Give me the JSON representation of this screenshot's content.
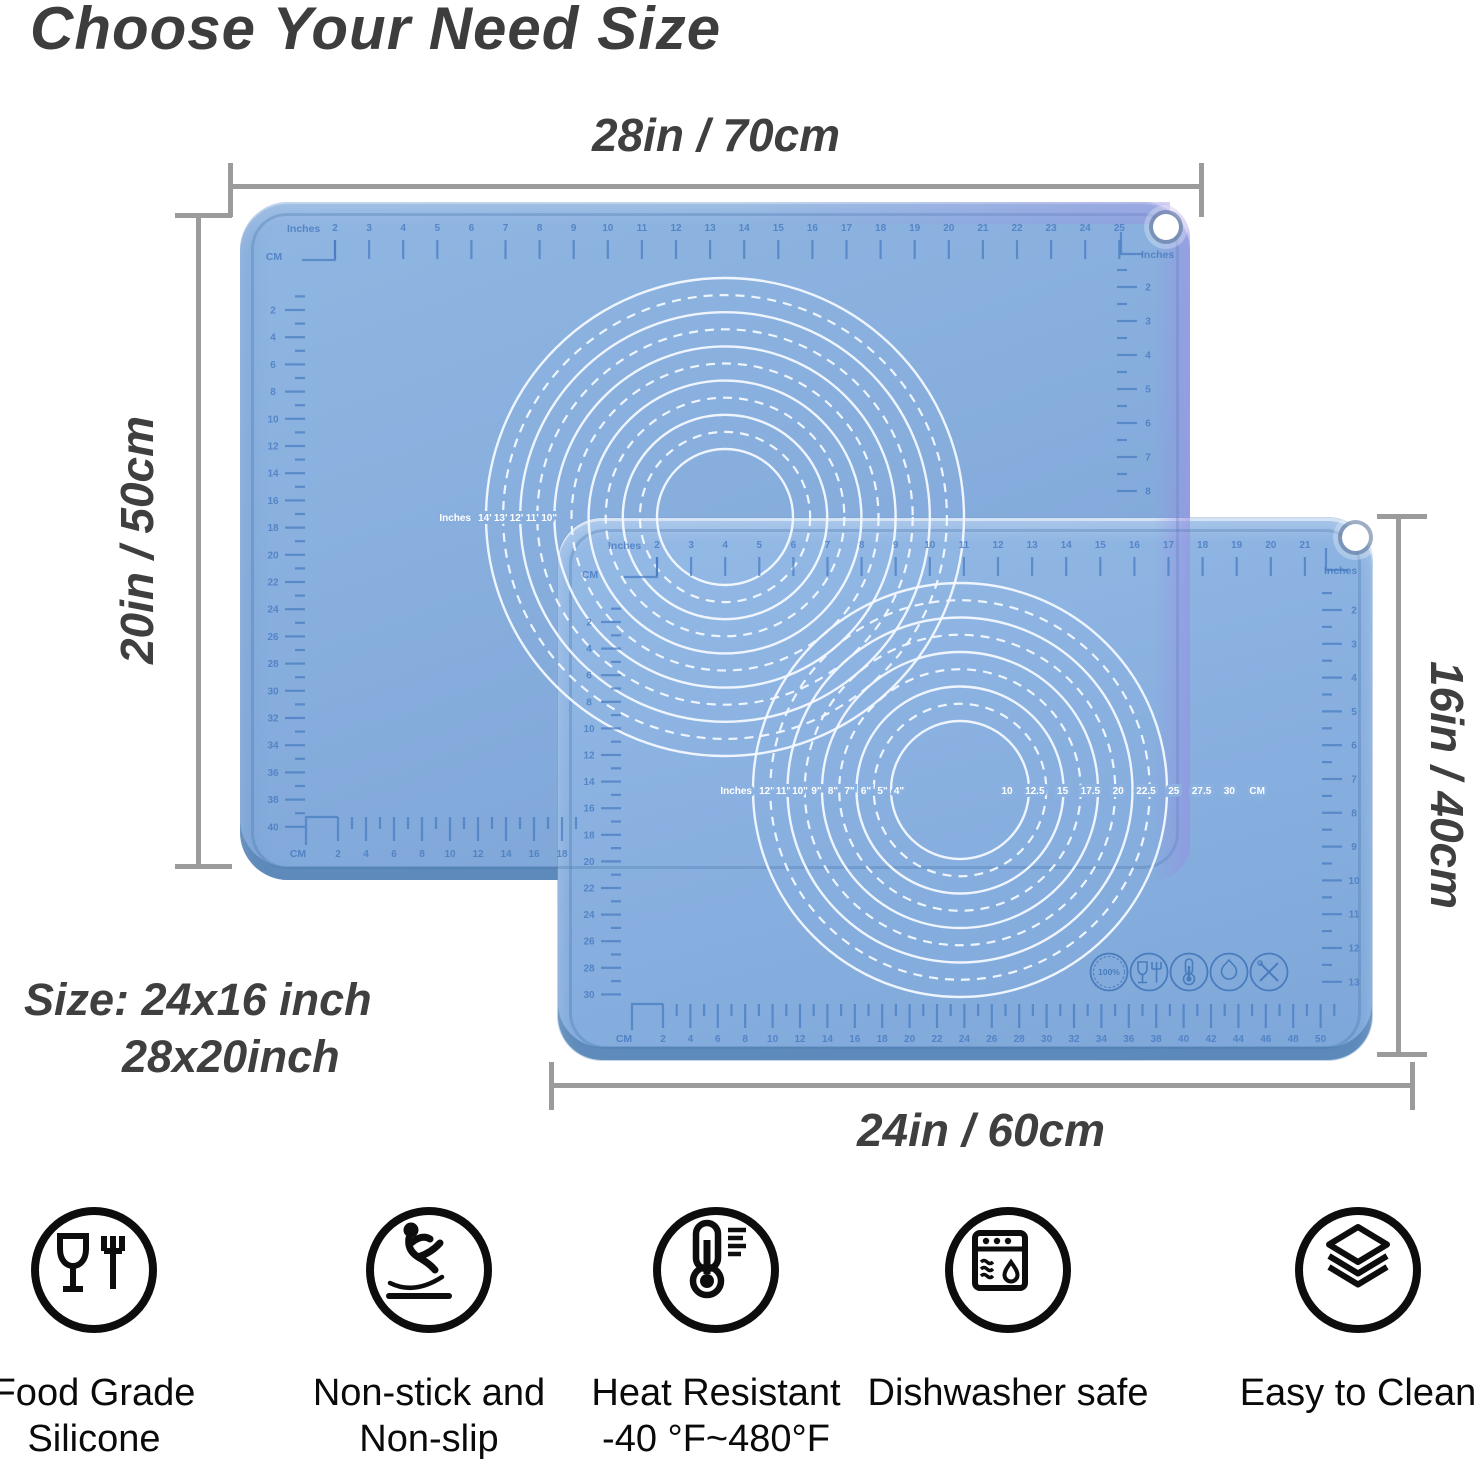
{
  "title": "Choose Your Need Size",
  "dimensions": {
    "top": "28in / 70cm",
    "left": "20in / 50cm",
    "right": "16in / 40cm",
    "bottom": "24in / 60cm"
  },
  "size_note": {
    "line1": "Size: 24x16 inch",
    "line2": "28x20inch"
  },
  "colors": {
    "mat_big": "#87aedd",
    "mat_front": "#8ab1e0",
    "ruler_ink": "#4579c0",
    "circle_white": "#f4f9ff",
    "dim_gray": "#9b9b9b",
    "text_dark": "#3f3f3f",
    "purple_edge": "#988ce2"
  },
  "mats": {
    "big": {
      "rulers": {
        "top": {
          "label": "Inches",
          "numbers": [
            2,
            3,
            4,
            5,
            6,
            7,
            8,
            9,
            10,
            11,
            12,
            13,
            14,
            15,
            16,
            17,
            18,
            19,
            20,
            21,
            22,
            23,
            24,
            25
          ]
        },
        "left": {
          "label": "CM",
          "numbers": [
            2,
            4,
            6,
            8,
            10,
            12,
            14,
            16,
            18,
            20,
            22,
            24,
            26,
            28,
            30,
            32,
            34,
            36,
            38,
            40
          ]
        },
        "right": {
          "label": "Inches",
          "numbers": [
            2,
            3,
            4,
            5,
            6,
            7,
            8
          ]
        },
        "bottom": {
          "label": "CM",
          "numbers": [
            2,
            4,
            6,
            8,
            10,
            12,
            14,
            16,
            18
          ]
        }
      },
      "circle_labels_left": [
        "Inches",
        "14\"",
        "13\"",
        "12\"",
        "11\"",
        "10\""
      ]
    },
    "front": {
      "rulers": {
        "top": {
          "label": "Inches",
          "numbers": [
            2,
            3,
            4,
            5,
            6,
            7,
            8,
            9,
            10,
            11,
            12,
            13,
            14,
            15,
            16,
            17,
            18,
            19,
            20,
            21
          ]
        },
        "left": {
          "label": "CM",
          "numbers": [
            2,
            4,
            6,
            8,
            10,
            12,
            14,
            16,
            18,
            20,
            22,
            24,
            26,
            28,
            30
          ]
        },
        "right": {
          "label": "Inches",
          "numbers": [
            2,
            3,
            4,
            5,
            6,
            7,
            8,
            9,
            10,
            11,
            12,
            13
          ]
        },
        "bottom": {
          "label": "CM",
          "numbers": [
            2,
            4,
            6,
            8,
            10,
            12,
            14,
            16,
            18,
            20,
            22,
            24,
            26,
            28,
            30,
            32,
            34,
            36,
            38,
            40,
            42,
            44,
            46,
            48,
            50
          ]
        }
      },
      "circle_labels_left": [
        "Inches",
        "12\"",
        "11\"",
        "10\"",
        "9\"",
        "8\"",
        "7\"",
        "6\"",
        "5\"",
        "4\""
      ],
      "circle_labels_right": [
        "10",
        "12.5",
        "15",
        "17.5",
        "20",
        "22.5",
        "25",
        "27.5",
        "30",
        "CM"
      ],
      "badges": [
        {
          "icon": "badge-100-food-grade-icon",
          "text": "100%"
        },
        {
          "icon": "badge-glass-fork-icon"
        },
        {
          "icon": "badge-thermometer-icon"
        },
        {
          "icon": "badge-flame-icon"
        },
        {
          "icon": "badge-crossed-utensils-icon"
        }
      ]
    }
  },
  "features": [
    {
      "icon": "food-safe-icon",
      "lines": [
        "Food Grade",
        "Silicone"
      ]
    },
    {
      "icon": "non-slip-icon",
      "lines": [
        "Non-stick and",
        "Non-slip"
      ]
    },
    {
      "icon": "heat-resistant-icon",
      "lines": [
        "Heat Resistant",
        "-40 °F~480°F"
      ]
    },
    {
      "icon": "dishwasher-icon",
      "lines": [
        "Dishwasher safe"
      ]
    },
    {
      "icon": "easy-clean-icon",
      "lines": [
        "Easy to Clean"
      ]
    }
  ]
}
